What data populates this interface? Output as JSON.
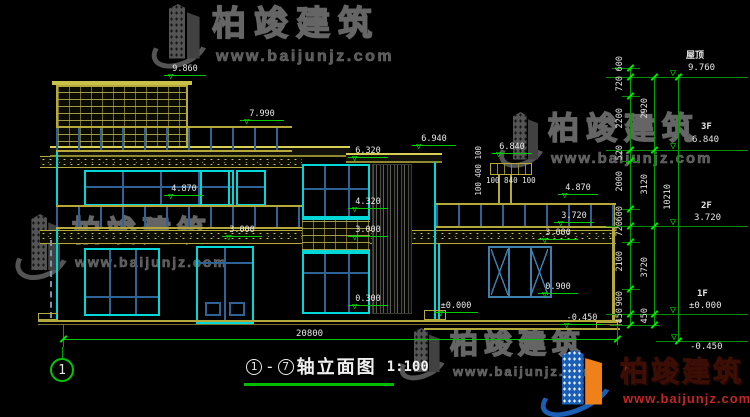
{
  "title": {
    "axis_from": "1",
    "axis_to": "7",
    "name": "轴立面图",
    "scale": "1:100"
  },
  "axis_bubble": "1",
  "watermark": {
    "name": "柏竣建筑",
    "url": "www.baijunjz.com"
  },
  "marks": {
    "tower_top": "9.860",
    "main_roof": "7.990",
    "parapet_right": "6.940",
    "window_head_2f": "6.320",
    "pillar_top": "6.840",
    "balcony_left": "4.870",
    "spandrel_top": "4.320",
    "floor2_left": "3.000",
    "floor2_mid": "3.000",
    "sill_1f": "0.300",
    "ground_mid": "±0.000",
    "balcony_right": "4.870",
    "wing_roof": "3.720",
    "wing_beam": "3.000",
    "wing_sill": "0.900",
    "wing_base": "-0.450"
  },
  "right_levels": {
    "roof": {
      "label": "屋顶",
      "value": "9.760"
    },
    "f3": {
      "label": "3F",
      "value": "6.840"
    },
    "f2": {
      "label": "2F",
      "value": "3.720"
    },
    "f1": {
      "label": "1F",
      "value": "±0.000"
    },
    "base": {
      "value": "-0.450"
    }
  },
  "dims": {
    "chain_inner": [
      "600",
      "720",
      "2200",
      "520",
      "2000",
      "600",
      "720",
      "2100",
      "900",
      "450"
    ],
    "chain_floor": [
      "2920",
      "3120",
      "3720",
      "450"
    ],
    "total_height": "10210",
    "total_width": "20800",
    "pillar_vertical": "100 400 100",
    "pillar_horizontal": "100 840 100"
  }
}
